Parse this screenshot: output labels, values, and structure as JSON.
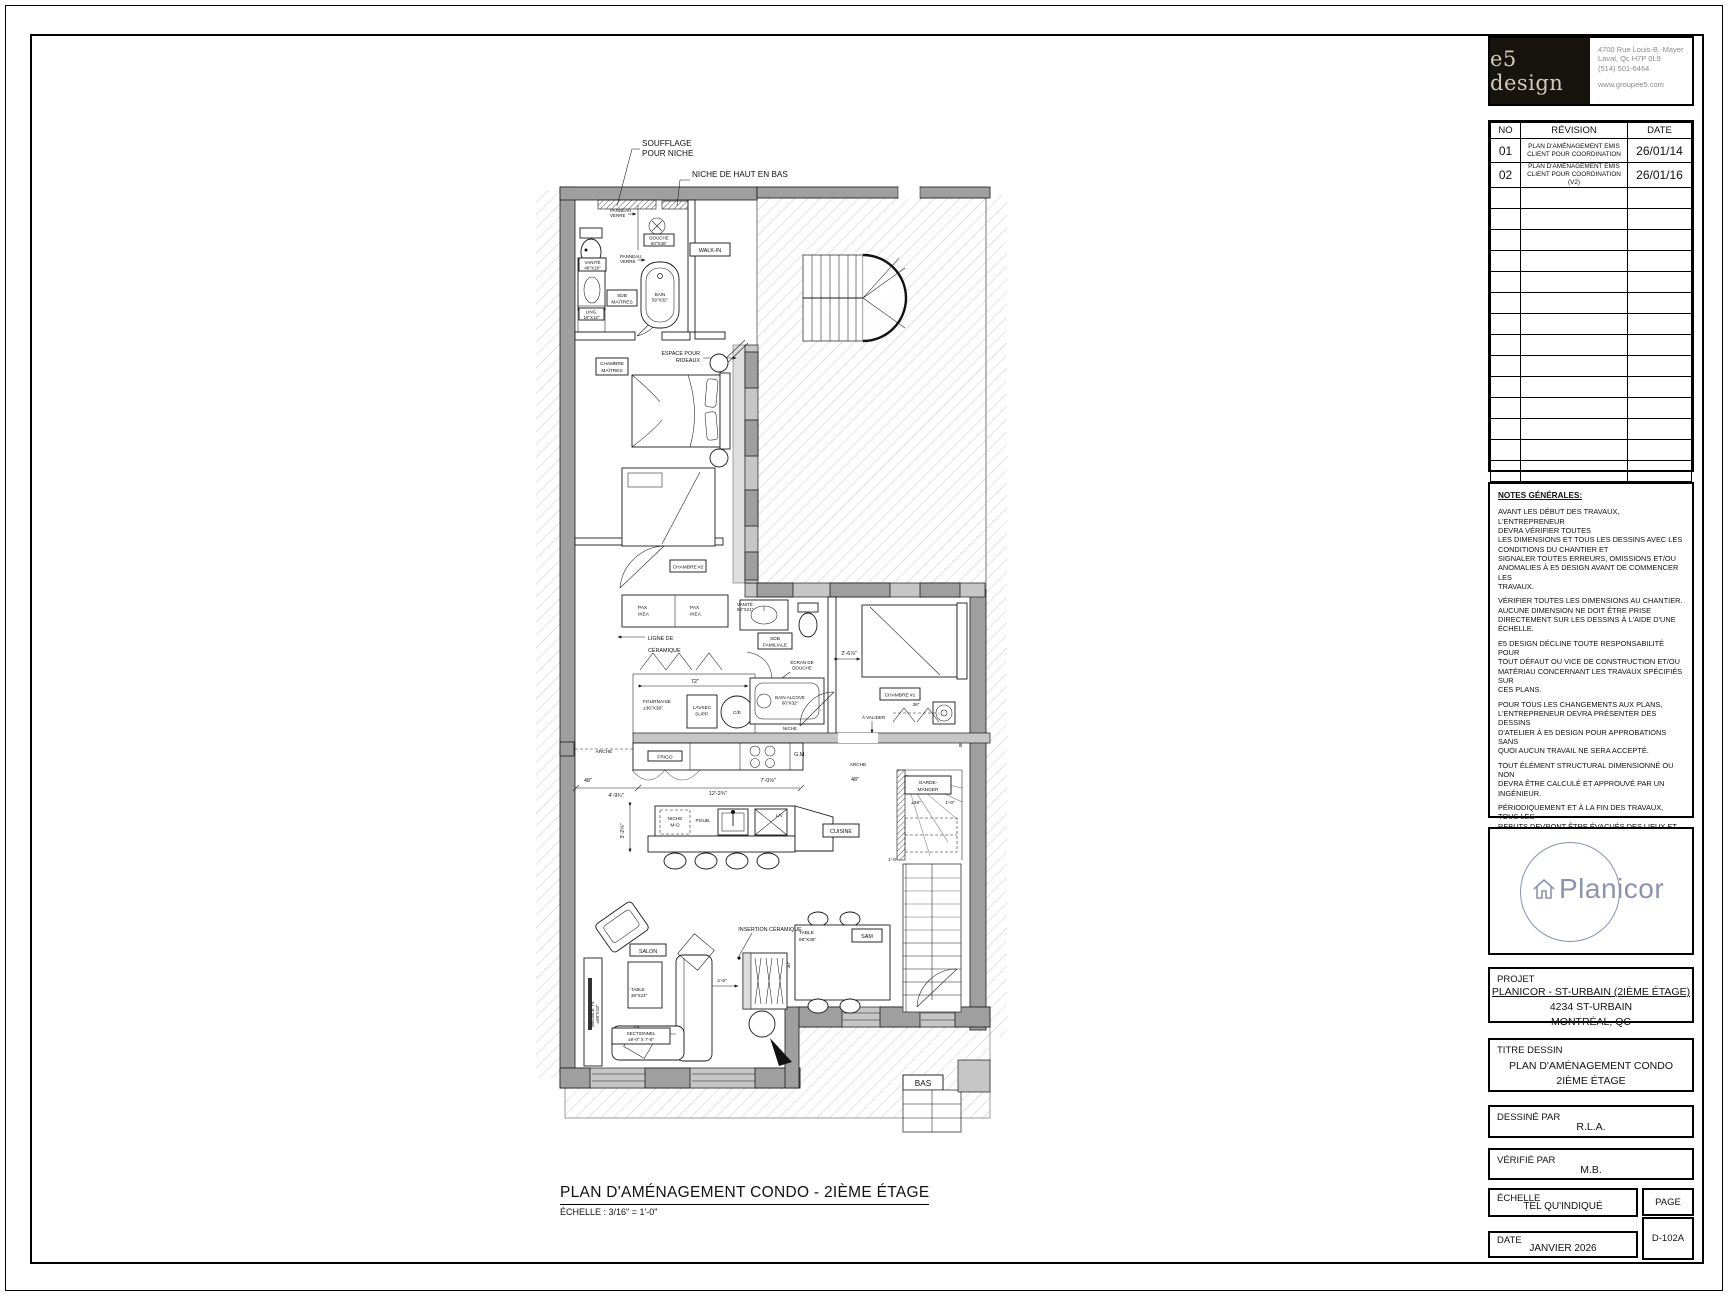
{
  "sheet": {
    "title": "PLAN D'AMÉNAGEMENT CONDO - 2IÈME ÉTAGE",
    "scale_note": "ÉCHELLE : 3/16\" = 1'-0\""
  },
  "logo_block": {
    "brand": "e5 design",
    "address_line1": "4700 Rue Louis-B.-Mayer",
    "address_line2": "Laval, Qc H7P 0L9",
    "phone": "(514) 501-6464",
    "website": "www.groupee5.com"
  },
  "revision_table": {
    "headers": [
      "NO",
      "RÉVISION",
      "DATE"
    ],
    "rows": [
      {
        "no": "01",
        "desc1": "PLAN D'AMÉNAGEMENT EMIS",
        "desc2": "CLIENT POUR COORDINATION",
        "date": "26/01/14"
      },
      {
        "no": "02",
        "desc1": "PLAN D'AMÉNAGEMENT EMIS",
        "desc2": "CLIENT POUR COORDINATION (V2)",
        "date": "26/01/16"
      }
    ],
    "empty_row_count": 14
  },
  "notes": {
    "title": "NOTES GÉNÉRALES:",
    "paragraphs": [
      "AVANT LES DÉBUT DES TRAVAUX, L'ENTREPRENEUR\nDEVRA VÉRIFIER TOUTES\nLES DIMENSIONS ET TOUS LES DESSINS AVEC LES\nCONDITIONS DU CHANTIER ET\nSIGNALER TOUTES ERREURS, OMISSIONS ET/OU\nANOMALIES À E5 DESIGN AVANT DE COMMENCER LES\nTRAVAUX.",
      "VÉRIFIER TOUTES LES DIMENSIONS AU CHANTIER.\nAUCUNE DIMENSION NE DOIT ÊTRE PRISE\nDIRECTEMENT SUR LES DESSINS À L'AIDE D'UNE\nÉCHELLE.",
      "E5 DESIGN DÉCLINE TOUTE RESPONSABILITÉ POUR\nTOUT DÉFAUT OU VICE DE CONSTRUCTION ET/OU\nMATÉRIAU CONCERNANT LES TRAVAUX SPÉCIFIÉS SUR\nCES PLANS.",
      "POUR TOUS LES CHANGEMENTS AUX PLANS,\nL'ENTREPRENEUR DEVRA PRÉSENTER DES DESSINS\nD'ATELIER À E5 DESIGN POUR APPROBATIONS SANS\nQUOI AUCUN TRAVAIL NE SERA ACCEPTÉ.",
      "TOUT ÉLÉMENT STRUCTURAL DIMENSIONNÉ OU NON\nDEVRA ÊTRE CALCULÉ ET APPROUVÉ PAR UN\nINGÉNIEUR.",
      "PÉRIODIQUEMENT ET À LA FIN DES TRAVAUX, TOUS LES\nREBUTS DEVRONT ÊTRE ÉVACUÉS DES LIEUX ET LE\nLOCAL MAINTENU EN ORDRE.",
      "TOUS LES PLANS, DESSINS ET DEVIS SONT LA\nPROPRIÉTÉ DE E5 DESIGN ET NE PEUVENT ÊTRE\nUTILISÉS POUR UN AUTRE PROJET QUE CELUI\nMENTIONNÉ SUR CEUX-CI."
    ]
  },
  "planicor_logo": {
    "name": "Planicor",
    "accent": "#8b93ae"
  },
  "project_block": {
    "label": "PROJET",
    "name": "PLANICOR - ST-URBAIN (2IÈME ÉTAGE)",
    "address": "4234 ST-URBAIN",
    "city": "MONTRÉAL, QC"
  },
  "title_block": {
    "label": "TITRE DESSIN",
    "line1": "PLAN D'AMÉNAGEMENT CONDO",
    "line2": "2IÈME ÉTAGE"
  },
  "drawn_by": {
    "label": "DESSINÉ PAR",
    "value": "R.L.A."
  },
  "checked_by": {
    "label": "VÉRIFIÉ PAR",
    "value": "M.B."
  },
  "scale_block": {
    "label": "ÉCHELLE",
    "value": "TEL QU'INDIQUÉ"
  },
  "date_block": {
    "label": "DATE",
    "value": "JANVIER 2026"
  },
  "page_block": {
    "label": "PAGE",
    "value": "D-102A"
  },
  "plan": {
    "labels": {
      "souffle1": "SOUFFLAGE",
      "souffle2": "POUR NICHE",
      "niche_hb": "NICHE DE HAUT EN BAS",
      "panneau1a": "PANNEAU",
      "panneau1b": "VERRE",
      "panneau2a": "PANNEAU",
      "panneau2b": "VERRE",
      "douche1": "DOUCHE",
      "douche2": "60\"X36\"",
      "vanite1a": "VANITÉ",
      "vanite1b": "48\"X19\"",
      "sdbm1": "SDB",
      "sdbm2": "MAÎTRES",
      "bain1": "BAIN",
      "bain2": "59\"X32\"",
      "ling1": "LING.",
      "ling2": "16\"X12\"",
      "walkin": "WALK-IN",
      "rideaux1": "ESPACE POUR",
      "rideaux2": "RIDEAUX",
      "chm1": "CHAMBRE",
      "chm2": "MAÎTRES",
      "ch2": "CHAMBRE #2",
      "pax1a": "PAX",
      "pax1b": "IKEA",
      "pax2a": "PAX",
      "pax2b": "IKEA",
      "ligne1": "LIGNE DE",
      "ligne2": "CÉRAMIQUE",
      "vanite2a": "VANITÉ",
      "vanite2b": "54\"X21\"",
      "sdbf1": "SDB",
      "sdbf2": "FAMILIALE",
      "ecran1": "ÉCRAN DE",
      "ecran2": "DOUCHE",
      "bainalc1": "BAIN ALCOVE",
      "bainalc2": "60\"X32\"",
      "niche": "NICHE",
      "ch1": "CHAMBRE #1",
      "avalider": "À VALIDER",
      "fournaise1": "FOURNAISE",
      "fournaise2": "±36\"X36\"",
      "lavsec1": "LAVSEC",
      "lavsec2": "SUPP.",
      "ce": "C/E",
      "frigo": "FRIGO",
      "gm": "G.M.",
      "arche1": "ARCHE",
      "arche2": "ARCHE",
      "gardemanger1": "GARDE-",
      "gardemanger2": "MANGER",
      "cuisine": "CUISINE",
      "nichemo1": "NICHE",
      "nichemo2": "M-O",
      "poub": "POUB.",
      "lv": "L/V",
      "sam": "SAM",
      "tablesam1": "TABLE",
      "tablesam2": "66\"X36\"",
      "insertion": "INSERTION CÉRAMIQUE",
      "salon": "SALON",
      "tablesalon1": "TABLE",
      "tablesalon2": "36\"X24\"",
      "sectionnel1": "SECTIONNEL",
      "sectionnel2": "±9'-0\" X 7'-6\"",
      "meubletv1": "MEUBLE TV",
      "meubletv2": "±60\"X18\"",
      "bas": "BAS"
    },
    "dims": {
      "d72": "72\"",
      "d48a": "48\"",
      "d48b": "48\"",
      "d4_9": "4'-9¾\"",
      "d12_2": "12'-2¾\"",
      "d7_0": "7'-0⅝\"",
      "d36a": "36\"",
      "d36b": "36\"",
      "d2_6": "2'-6⅞\"",
      "d3_2": "3'-2⅝\"",
      "dpm30": "±30\"",
      "dpm55": "±55⅞\"",
      "dpm36": "±36\"",
      "d1_0a": "1'-0\"",
      "d1_0b": "1'-0\"",
      "d2_6b": "2'-6\"",
      "d30": "30\""
    }
  }
}
